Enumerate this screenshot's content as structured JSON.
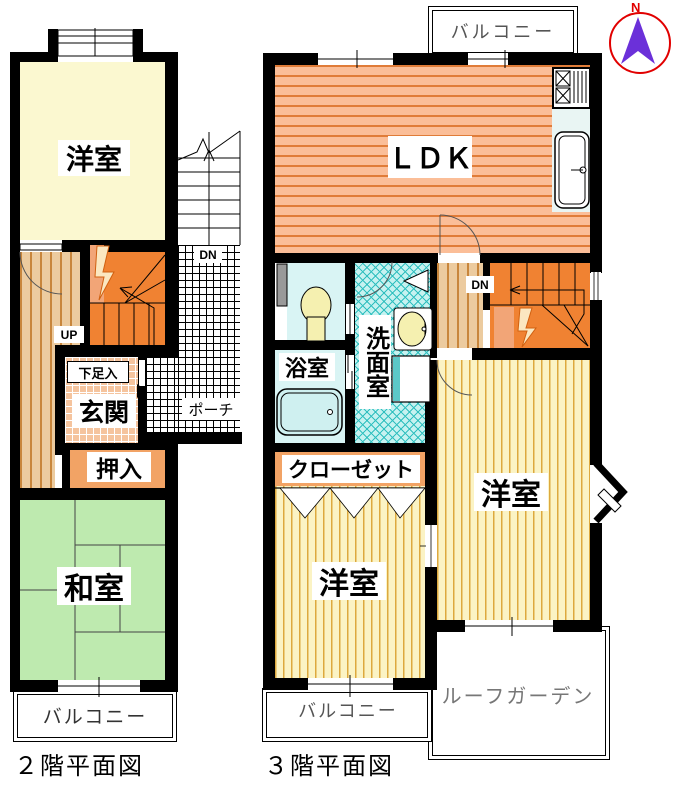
{
  "floor2": {
    "title": "２階平面図",
    "rooms": {
      "youshitsu": "洋室",
      "washitsu": "和室",
      "genkan": "玄関",
      "oshiire": "押入",
      "geta_box": "下足入",
      "porch": "ポーチ",
      "balcony": "バルコニー"
    },
    "stairs": {
      "up": "UP",
      "dn": "DN"
    }
  },
  "floor3": {
    "title": "３階平面図",
    "rooms": {
      "ldk": "ＬＤＫ",
      "youshitsu_right": "洋室",
      "youshitsu_center": "洋室",
      "bathroom": "浴室",
      "senmenshitsu": "洗面室",
      "closet": "クローゼット",
      "balcony_top": "バルコニー",
      "balcony_bottom": "バルコニー",
      "roof_garden": "ルーフガーデン"
    },
    "stairs": {
      "dn": "DN"
    }
  },
  "compass": {
    "north": "N"
  },
  "colors": {
    "wall": "#000000",
    "youshitsu_2f_fill": "#FBF8D0",
    "washitsu_fill": "#BEEAAF",
    "wood_floor": "#ECCB9F",
    "wood_stripe": "#C8863C",
    "stairs_orange": "#F08232",
    "ldk_fill": "#FBBE98",
    "ldk_stripe": "#E07C38",
    "youshitsu_3f_fill": "#FBF3C4",
    "youshitsu_3f_stripe": "#DDA93E",
    "washroom_fill": "#C6F2F0",
    "washroom_stripe": "#2FBFBF",
    "bath_fill": "#D9F4F4",
    "genkan_fill": "#F5C49E",
    "closet_fill": "#F2A365",
    "compass_circle": "#E10000",
    "compass_needle": "#6B30D9"
  }
}
